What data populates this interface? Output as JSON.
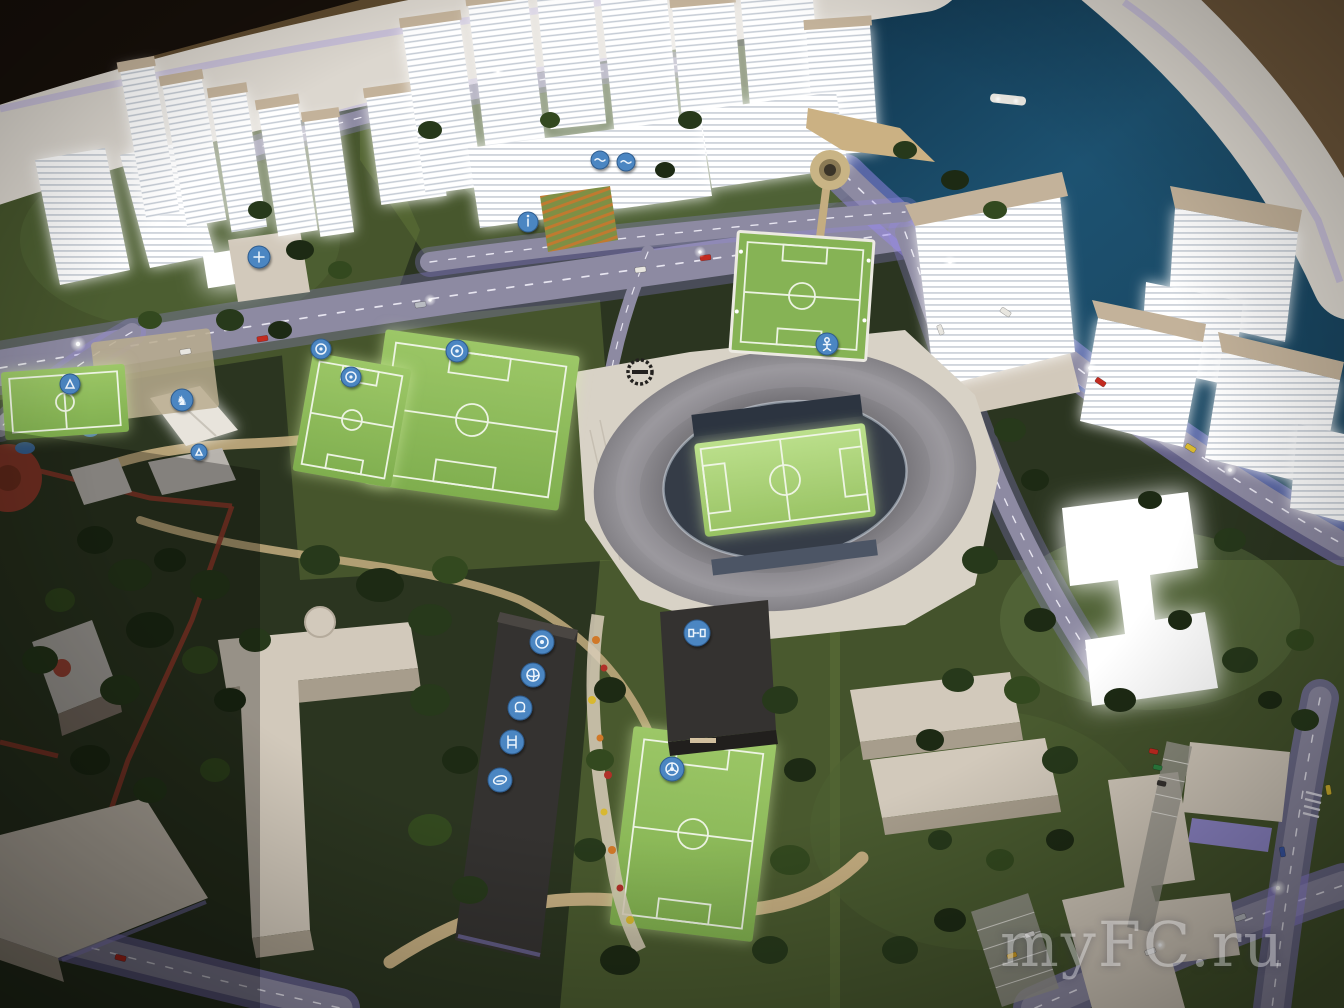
{
  "scene": {
    "description": "Night photograph of an illuminated architectural scale model: riverside city district with an oval football stadium, training pitches, glowing white residential towers, purple-lit roads and a historic red-brick quarter",
    "watermark": {
      "text": "myFC.ru",
      "color": "rgba(255,255,255,0.38)"
    }
  },
  "icons": {
    "list": [
      "soccer-ball",
      "volleyball",
      "boxing-glove",
      "gym",
      "rugby-ball",
      "goal",
      "medical-cross",
      "horse",
      "player",
      "pool",
      "playground",
      "info"
    ],
    "horse_glyph": "♞"
  },
  "palette": {
    "bg-dark": "#17100a",
    "bg-brown": "#5e4a2e",
    "rim": "#dcd7cf",
    "rim-edge": "#c3bbd8",
    "river-deep": "#0e2f45",
    "river": "#1d5271",
    "land": "#2b3520",
    "grass": "#46552c",
    "grass-light": "#5e7238",
    "pitch": "#86b355",
    "pitch-bright": "#a8d874",
    "road": "#8d8aa2",
    "road-glow": "#9a8fe6",
    "road-line": "#eceaf4",
    "path-tan": "#c4ad80",
    "plaza": "#d8d2c6",
    "building-white": "#ffffff",
    "building-beige": "#d2c9bb",
    "building-beige-side": "#a79d8c",
    "roof-tan": "#c3b29a",
    "building-dark": "#343230",
    "roof-gray": "#b7b3ad",
    "brick-red": "#8d3a2a",
    "disc-blue": "#4c86c2",
    "stadium-ring": "#8b898e",
    "stadium-bowl": "#353c47",
    "tree-dark": "#1d2a14",
    "tree-mid": "#27391b",
    "tree-light": "#33491f",
    "watermark": "rgba(255,255,255,0.38)"
  }
}
